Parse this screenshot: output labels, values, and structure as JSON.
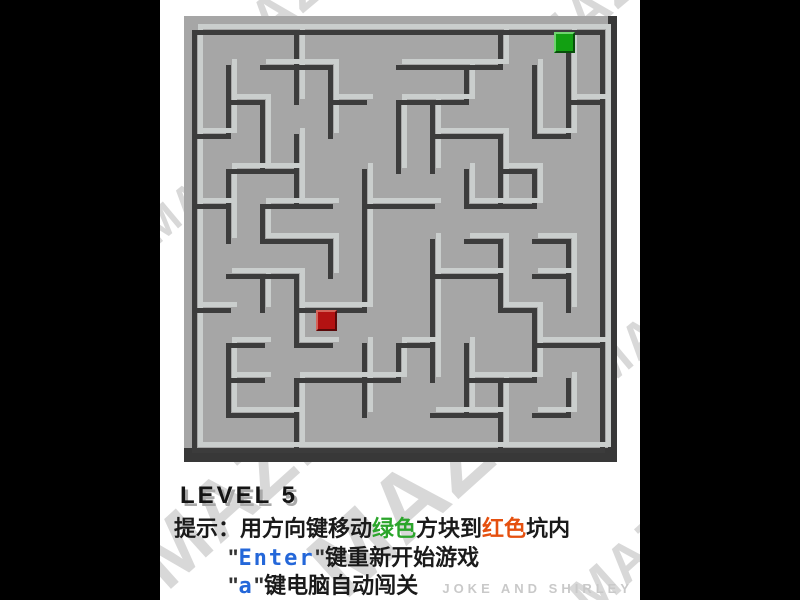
{
  "window": {
    "width": 800,
    "height": 600,
    "sidebar_color": "#000000",
    "content_bg": "#ffffff"
  },
  "watermark": {
    "text": "MAZE",
    "color": "#d8d8d8",
    "instances": [
      {
        "left": 40,
        "top": -28,
        "size": 56,
        "rot": -40
      },
      {
        "left": 355,
        "top": -32,
        "size": 56,
        "rot": -40
      },
      {
        "left": -28,
        "top": 168,
        "size": 44,
        "rot": -40
      },
      {
        "left": 416,
        "top": 300,
        "size": 50,
        "rot": -40
      },
      {
        "left": -42,
        "top": 445,
        "size": 82,
        "rot": -42
      },
      {
        "left": 128,
        "top": 432,
        "size": 94,
        "rot": -42
      },
      {
        "left": 398,
        "top": 520,
        "size": 54,
        "rot": -42
      }
    ]
  },
  "maze": {
    "grid": {
      "cols": 12,
      "rows": 12,
      "origin_x": 40,
      "origin_y": 26,
      "cell_w": 34,
      "cell_h": 34.8,
      "wall_thickness": 5,
      "shadow_offset": 6
    },
    "colors": {
      "floor": "#a6a6a6",
      "wall_top": "#cacecd",
      "wall_shadow": "#3c3c3c",
      "slab_edge": "#383838"
    },
    "slab": {
      "left": 24,
      "top": 16,
      "width": 424,
      "height": 432
    },
    "walls_v": [
      [
        0,
        0,
        12
      ],
      [
        12,
        0,
        12
      ],
      [
        3,
        0,
        2
      ],
      [
        9,
        0,
        1
      ],
      [
        11,
        0,
        3
      ],
      [
        1,
        1,
        2
      ],
      [
        4,
        1,
        2
      ],
      [
        8,
        1,
        1
      ],
      [
        10,
        1,
        2
      ],
      [
        2,
        2,
        2
      ],
      [
        6,
        2,
        2
      ],
      [
        7,
        2,
        2
      ],
      [
        3,
        3,
        2
      ],
      [
        9,
        3,
        2
      ],
      [
        1,
        4,
        2
      ],
      [
        5,
        4,
        2
      ],
      [
        8,
        4,
        1
      ],
      [
        10,
        4,
        1
      ],
      [
        2,
        5,
        1
      ],
      [
        4,
        6,
        1
      ],
      [
        5,
        6,
        2
      ],
      [
        7,
        6,
        2
      ],
      [
        9,
        6,
        2
      ],
      [
        11,
        6,
        2
      ],
      [
        2,
        7,
        1
      ],
      [
        3,
        7,
        2
      ],
      [
        7,
        8,
        2
      ],
      [
        10,
        8,
        2
      ],
      [
        1,
        9,
        2
      ],
      [
        5,
        9,
        2
      ],
      [
        6,
        9,
        1
      ],
      [
        8,
        9,
        2
      ],
      [
        3,
        10,
        2
      ],
      [
        9,
        10,
        2
      ],
      [
        11,
        10,
        1
      ]
    ],
    "walls_h": [
      [
        0,
        0,
        12
      ],
      [
        12,
        0,
        12
      ],
      [
        1,
        2,
        2
      ],
      [
        1,
        6,
        2
      ],
      [
        1,
        8,
        1
      ],
      [
        2,
        1,
        1
      ],
      [
        2,
        4,
        1
      ],
      [
        2,
        6,
        2
      ],
      [
        2,
        11,
        1
      ],
      [
        3,
        0,
        1
      ],
      [
        3,
        7,
        2
      ],
      [
        3,
        10,
        1
      ],
      [
        4,
        1,
        2
      ],
      [
        4,
        9,
        1
      ],
      [
        5,
        0,
        1
      ],
      [
        5,
        2,
        2
      ],
      [
        5,
        5,
        2
      ],
      [
        5,
        8,
        2
      ],
      [
        6,
        2,
        2
      ],
      [
        6,
        8,
        1
      ],
      [
        6,
        10,
        1
      ],
      [
        7,
        1,
        2
      ],
      [
        7,
        7,
        2
      ],
      [
        7,
        10,
        1
      ],
      [
        8,
        0,
        1
      ],
      [
        8,
        3,
        2
      ],
      [
        8,
        9,
        1
      ],
      [
        9,
        1,
        1
      ],
      [
        9,
        3,
        1
      ],
      [
        9,
        6,
        1
      ],
      [
        9,
        10,
        2
      ],
      [
        10,
        1,
        1
      ],
      [
        10,
        3,
        2
      ],
      [
        10,
        5,
        1
      ],
      [
        10,
        8,
        2
      ],
      [
        11,
        1,
        2
      ],
      [
        11,
        7,
        2
      ],
      [
        11,
        10,
        1
      ]
    ],
    "blocks": {
      "size": 17,
      "offset_x": 14,
      "offset_y": 6,
      "green": {
        "col": 10,
        "row": 0,
        "color": "#12a012"
      },
      "red": {
        "col": 3,
        "row": 8,
        "color": "#b31212"
      }
    }
  },
  "footer": {
    "level_label": "LEVEL 5",
    "hint_prefix": "提示：用方向键移动",
    "hint_green": "绿色",
    "hint_mid": "方块到",
    "hint_red": "红色",
    "hint_suffix": "坑内",
    "line2_q1": "\"",
    "line2_key": "Enter",
    "line2_q2": "\"",
    "line2_rest": "键重新开始游戏",
    "line3_q1": "\"",
    "line3_key": "a",
    "line3_q2": "\"",
    "line3_rest": "键电脑自动闯关",
    "credit": "JOKE AND SHIRLEY",
    "colors": {
      "level": "#141414",
      "level_shadow": "#a9a9a9",
      "text": "#1a1a1a",
      "green": "#2ba52b",
      "red": "#e5500f",
      "blue": "#2467d9",
      "credit": "#c9c9c9"
    }
  }
}
